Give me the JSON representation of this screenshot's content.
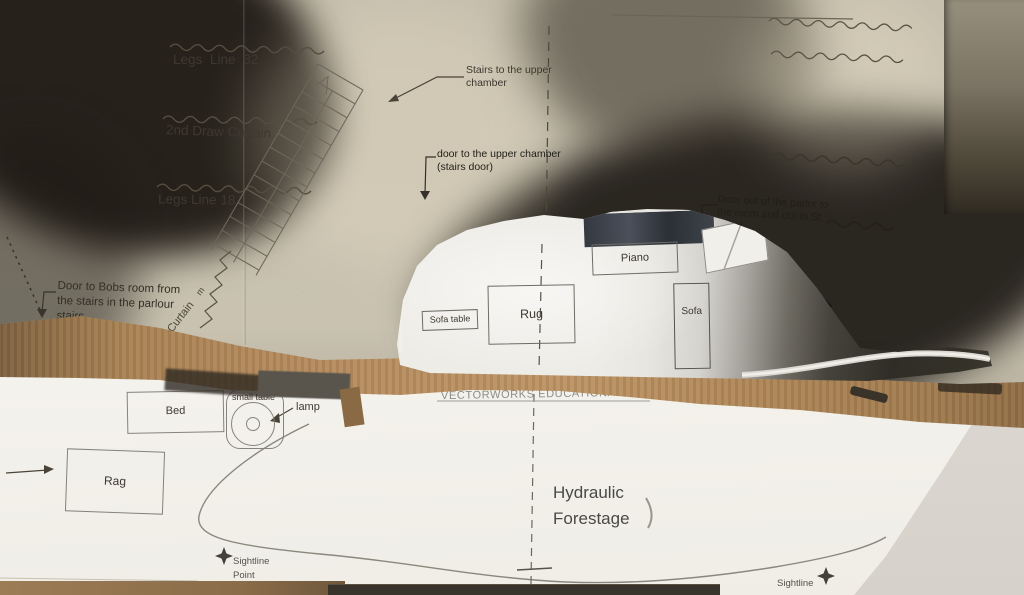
{
  "plan_upper": {
    "leg_lines": [
      "Legs Line 32",
      "2nd Draw Curtain",
      "Legs Line 18"
    ],
    "notes": {
      "stairs": [
        "Stairs to the upper",
        "chamber"
      ],
      "door_upper": [
        "door to the upper chamber",
        "(stairs door)"
      ],
      "door_parlor": [
        "Door out of the parlor to",
        "the room and out to St",
        "street"
      ],
      "door_bobs": [
        "Door to Bobs room from",
        "the stairs in the parlour",
        "stairs"
      ],
      "curtain": "Curtain",
      "curtain_mark": "m"
    },
    "furniture": {
      "piano": "Piano",
      "sofa_table": "Sofa table",
      "rug": "Rug",
      "sofa": "Sofa"
    }
  },
  "plan_lower": {
    "watermark": "VECTORWORKS EDUCATIONAL VERSION",
    "furniture": {
      "bed": "Bed",
      "small_table": "small table",
      "lamp": "lamp",
      "rag": "Rag"
    },
    "forestage": [
      "Hydraulic",
      "Forestage"
    ],
    "sightlines": {
      "point": [
        "Sightline",
        "Point"
      ],
      "line": "Sightline"
    }
  },
  "colors": {
    "paper_upper": "#c7c0ae",
    "paper_model": "#efede8",
    "paper_lower": "#f5f3ee",
    "cardboard": "#b3895c",
    "shadow": "#2b2620",
    "ink": "#3e3831",
    "watermark_gray": "#8b8b85",
    "wall": "#d9d5ce"
  }
}
